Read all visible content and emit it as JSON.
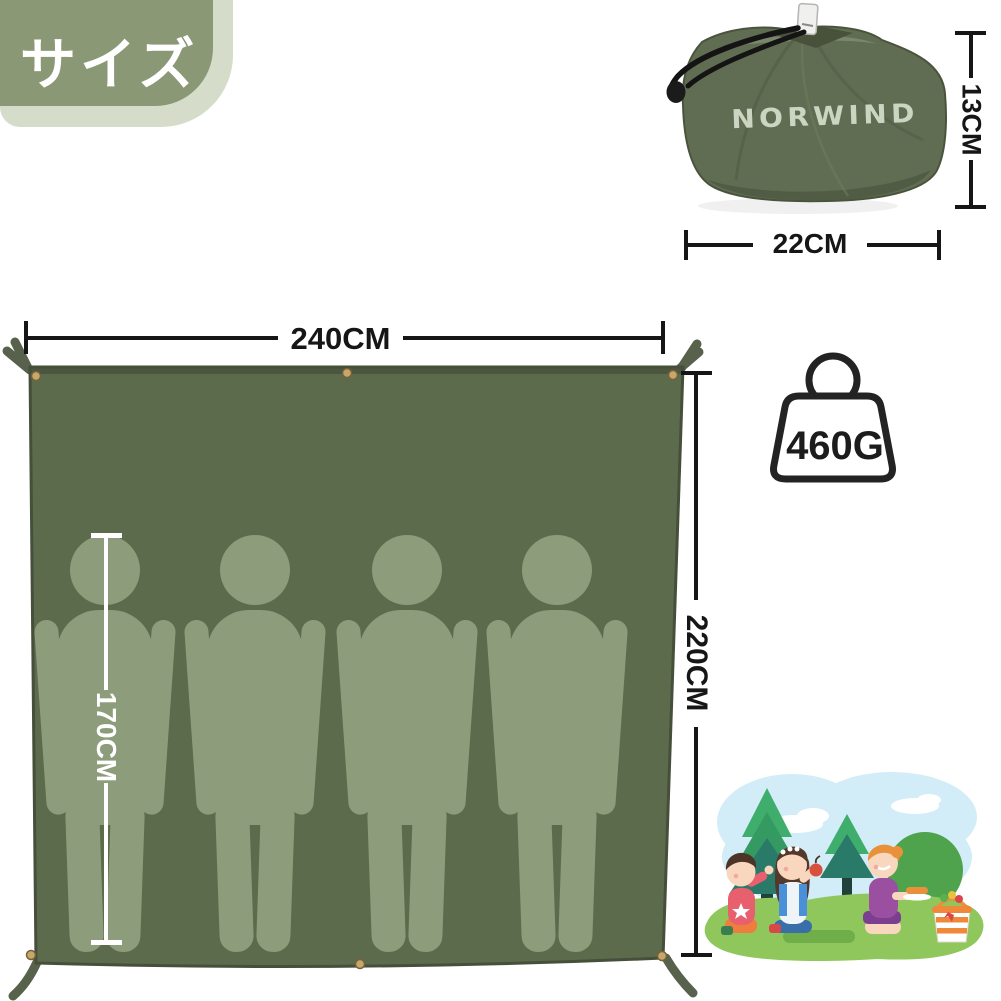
{
  "badge": {
    "label": "サイズ"
  },
  "pouch": {
    "brand": "NORWIND",
    "height_label": "13CM",
    "width_label": "22CM"
  },
  "tarp": {
    "width_label": "240CM",
    "height_label": "220CM",
    "person_height_label": "170CM",
    "person_count": 4,
    "grommet_count": 6
  },
  "weight": {
    "label": "460G"
  },
  "icons": {
    "weight": "weight-icon",
    "stuff_sack": "stuff-sack-photo",
    "illustration": "kids-picnic-illustration"
  },
  "colors": {
    "badge_green": "#8a9876",
    "badge_shadow": "#d5dcc9",
    "tarp_green": "#5d6b4d",
    "tarp_edge": "#454f3a",
    "silhouette_green": "#8d9c7a",
    "pouch_green": "#616d53",
    "logo_text": "#ccd5c2",
    "grommet_brass": "#c8a76b",
    "dimension_line": "#161616",
    "person_measure_line": "#ffffff"
  }
}
